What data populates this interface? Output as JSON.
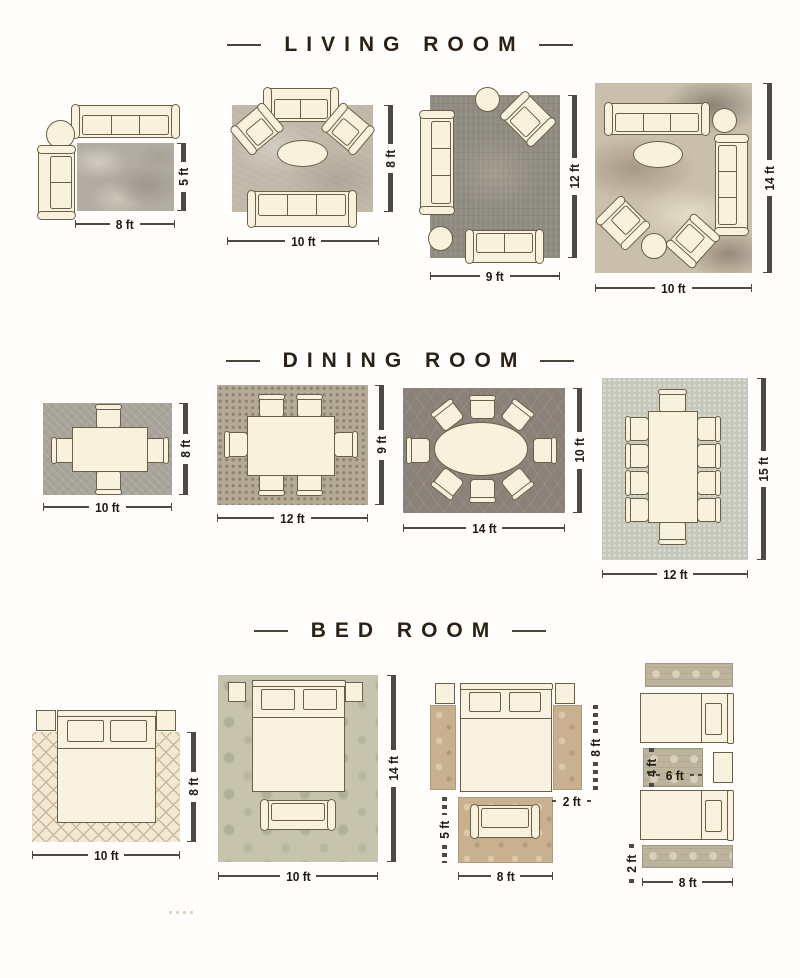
{
  "titles": {
    "living": "LIVING ROOM",
    "dining": "DINING ROOM",
    "bed": "BED ROOM"
  },
  "living": {
    "layouts": [
      {
        "width_label": "8 ft",
        "height_label": "5 ft",
        "furniture": [
          "three-seat-sofa",
          "round-side-table",
          "two-seat-sofa",
          "area-rug"
        ]
      },
      {
        "width_label": "10 ft",
        "height_label": "8 ft",
        "furniture": [
          "two-seat-sofa",
          "armchair",
          "armchair",
          "oval-coffee-table",
          "three-seat-sofa",
          "area-rug"
        ]
      },
      {
        "width_label": "9 ft",
        "height_label": "12 ft",
        "furniture": [
          "round-side-table",
          "armchair",
          "three-seat-sofa",
          "round-side-table",
          "loveseat",
          "area-rug"
        ]
      },
      {
        "width_label": "10 ft",
        "height_label": "14 ft",
        "furniture": [
          "three-seat-sofa",
          "round-side-table",
          "oval-coffee-table",
          "three-seat-sofa",
          "armchair",
          "armchair",
          "round-side-table",
          "area-rug"
        ]
      }
    ]
  },
  "dining": {
    "layouts": [
      {
        "width_label": "10 ft",
        "height_label": "8 ft",
        "furniture": [
          "dining-table",
          "chair-x4",
          "area-rug"
        ]
      },
      {
        "width_label": "12 ft",
        "height_label": "9 ft",
        "furniture": [
          "dining-table",
          "chair-x6",
          "area-rug"
        ]
      },
      {
        "width_label": "14 ft",
        "height_label": "10 ft",
        "furniture": [
          "oval-dining-table",
          "chair-x8",
          "area-rug"
        ]
      },
      {
        "width_label": "12 ft",
        "height_label": "15 ft",
        "furniture": [
          "long-dining-table",
          "chair-x10",
          "area-rug"
        ]
      }
    ]
  },
  "bed": {
    "layouts": [
      {
        "width_label": "10 ft",
        "height_label": "8 ft",
        "furniture": [
          "queen-bed",
          "nightstand",
          "nightstand",
          "area-rug"
        ]
      },
      {
        "width_label": "10 ft",
        "height_label": "14 ft",
        "furniture": [
          "queen-bed",
          "nightstand",
          "nightstand",
          "bench",
          "area-rug"
        ]
      },
      {
        "runner_height_label": "8 ft",
        "runner_width_label": "2 ft",
        "foot_rug_height_label": "5 ft",
        "foot_rug_width_label": "8 ft",
        "furniture": [
          "queen-bed",
          "nightstand",
          "nightstand",
          "runner-rug",
          "runner-rug",
          "bench",
          "foot-rug"
        ]
      },
      {
        "small_rug_height_label": "4 ft",
        "small_rug_width_label": "6 ft",
        "runner_height_label": "2 ft",
        "runner_width_label": "8 ft",
        "furniture": [
          "runner-rug",
          "twin-bed",
          "small-rug",
          "nightstand",
          "twin-bed",
          "runner-rug"
        ]
      }
    ]
  },
  "colors": {
    "background": "#ffffff",
    "title_text": "#2c2014",
    "dimension_text": "#1e1b16",
    "dimension_line": "#4d4a45",
    "furniture_fill": "#f8f1de",
    "furniture_outline": "#6b6044",
    "rug_living": [
      "#b2ada3",
      "#c0b7a8",
      "#8f8b80",
      "#cabfab"
    ],
    "rug_dining": [
      "#a8a49a",
      "#b5aa97",
      "#8a8178",
      "#c4c7b9"
    ],
    "rug_bed": [
      "#f3e9d3",
      "#c6c4ad",
      "#c9b190",
      "#beb39c"
    ]
  }
}
